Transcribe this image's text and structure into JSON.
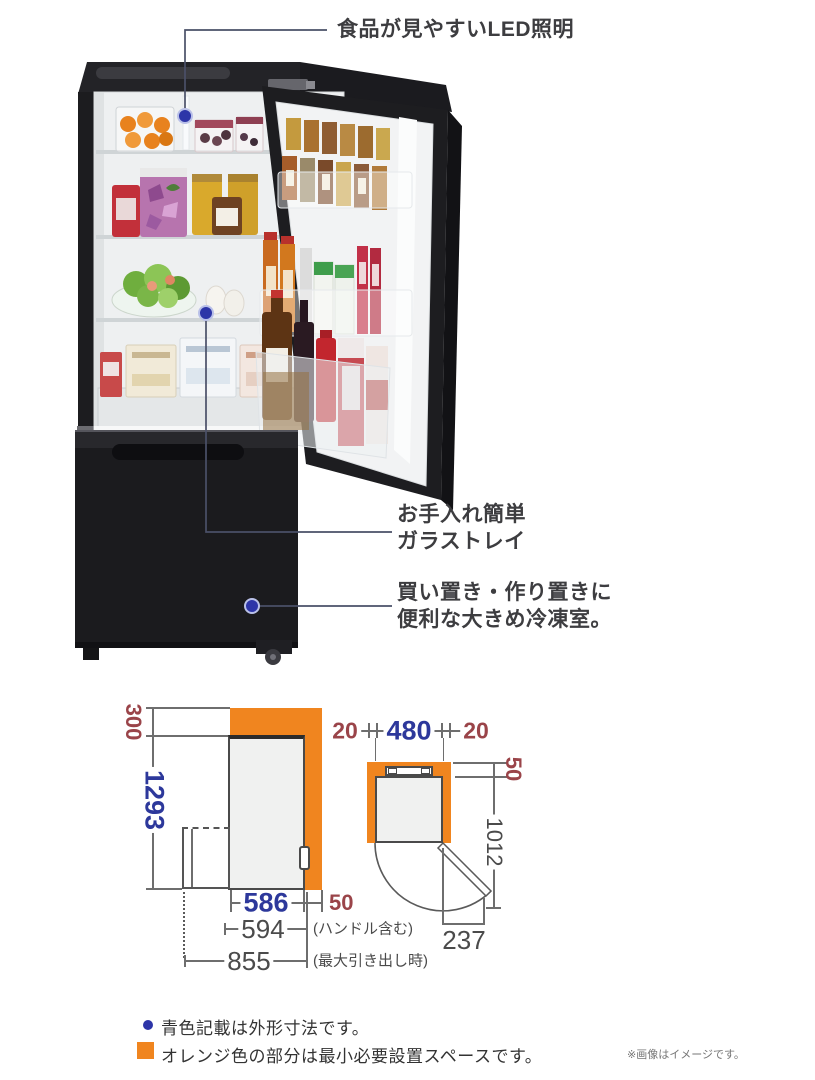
{
  "callouts": {
    "led": "食品が見やすいLED照明",
    "tray": [
      "お手入れ簡単",
      "ガラストレイ"
    ],
    "freezer": [
      "買い置き・作り置きに",
      "便利な大きめ冷凍室。"
    ]
  },
  "side_view": {
    "top_clearance": "300",
    "height": "1293",
    "depth": "586",
    "rear_clearance": "50",
    "depth_with_handle": "594",
    "depth_with_handle_note": "(ハンドル含む)",
    "depth_drawer_open": "855",
    "depth_drawer_open_note": "(最大引き出し時)"
  },
  "top_view": {
    "left_clearance": "20",
    "width": "480",
    "right_clearance": "20",
    "rear_clearance": "50",
    "depth_door_open": "1012",
    "door_protrusion": "237"
  },
  "legend": {
    "blue_note": "青色記載は外形寸法です。",
    "orange_note": "オレンジ色の部分は最小必要設置スペースです。",
    "disclaimer": "※画像はイメージです。"
  },
  "colors": {
    "install_space_orange": "#f0851f",
    "external_dim_blue": "#2d389b",
    "clearance_red": "#9a4449"
  }
}
